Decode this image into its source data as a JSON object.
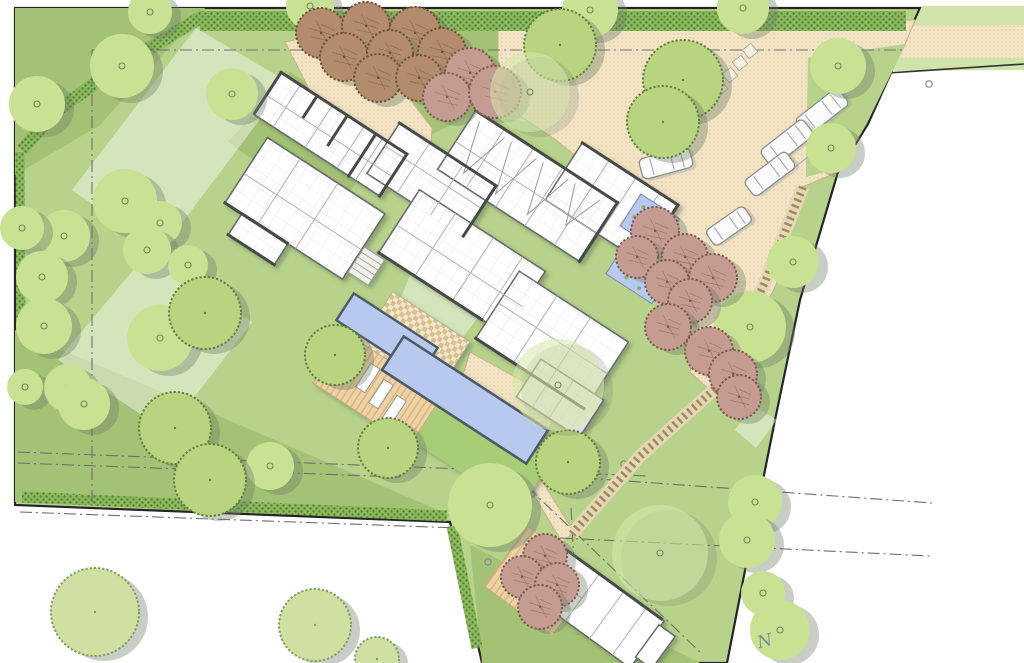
{
  "north_label": "N",
  "palette": {
    "base": "#b6d28b",
    "dark": "#a4c275",
    "hedge_bg": "#8cba5e",
    "hedge_dot": "#567f33",
    "sand": "#f2e4c5",
    "sand_dot": "#e0c9a0",
    "sand_edge": "#cbb286",
    "wood": "#ecd2a5",
    "wood_stripe": "#d8b27c",
    "pool": "#b7c9ee",
    "pool_edge": "#4f5a66",
    "wall": "#4a4a4a",
    "wall_light": "#6a6a6a",
    "room_line": "#b2b2b2",
    "boundary": "#252525",
    "dashline": "#6f6f6f",
    "tree_plain": "#c8e193",
    "tree_ring": "#74865c",
    "shadow": "#6f7f69",
    "tex_green": "#b9d47f",
    "tex_green_outline": "#5f7f3f",
    "tex_pale": "#cfe0a2",
    "tex_pale_outline": "#7f9f5f",
    "orchard": "#b28c6c",
    "orchard_outline": "#6e5138",
    "pink": "#c59c92",
    "pink_outline": "#80574d",
    "canopy": "#d7e8ab",
    "car_body": "#fbfbfb",
    "car_edge": "#8f8f8f",
    "road_verge": "#cfe3aa",
    "bright_panel": "#a7cd76",
    "pond_plant": "#7fae5e"
  },
  "site": {
    "outline": [
      [
        15,
        8
      ],
      [
        920,
        8
      ],
      [
        868,
        124
      ],
      [
        838,
        172
      ],
      [
        800,
        300
      ],
      [
        775,
        420
      ],
      [
        748,
        555
      ],
      [
        727,
        663
      ],
      [
        482,
        663
      ],
      [
        450,
        522
      ],
      [
        15,
        505
      ]
    ]
  },
  "lawn": {
    "dark": [
      [
        [
          15,
          8
        ],
        [
          205,
          8
        ],
        [
          100,
          125
        ],
        [
          15,
          175
        ]
      ],
      [
        [
          290,
          72
        ],
        [
          392,
          140
        ],
        [
          330,
          215
        ],
        [
          228,
          142
        ]
      ],
      [
        [
          15,
          330
        ],
        [
          240,
          425
        ],
        [
          452,
          516
        ],
        [
          15,
          502
        ]
      ],
      [
        [
          470,
          545
        ],
        [
          700,
          663
        ],
        [
          482,
          663
        ]
      ],
      [
        [
          300,
          22
        ],
        [
          505,
          22
        ],
        [
          505,
          100
        ],
        [
          430,
          135
        ],
        [
          330,
          70
        ]
      ]
    ],
    "pale": [
      [
        [
          196,
          28
        ],
        [
          288,
          82
        ],
        [
          160,
          252
        ],
        [
          72,
          190
        ]
      ],
      [
        [
          150,
          250
        ],
        [
          252,
          322
        ],
        [
          168,
          432
        ],
        [
          58,
          360
        ]
      ],
      [
        [
          410,
          275
        ],
        [
          492,
          300
        ],
        [
          455,
          347
        ],
        [
          388,
          330
        ]
      ],
      [
        [
          505,
          58
        ],
        [
          592,
          58
        ],
        [
          592,
          133
        ],
        [
          505,
          118
        ]
      ],
      [
        [
          752,
          405
        ],
        [
          777,
          420
        ],
        [
          756,
          448
        ],
        [
          735,
          430
        ]
      ]
    ]
  },
  "road": {
    "verge_top": [
      [
        922,
        6
      ],
      [
        1024,
        6
      ],
      [
        1024,
        25
      ],
      [
        913,
        26
      ]
    ],
    "lane": [
      [
        913,
        26
      ],
      [
        1024,
        25
      ],
      [
        1024,
        58
      ],
      [
        895,
        58
      ]
    ],
    "verge_bottom": [
      [
        895,
        58
      ],
      [
        1024,
        58
      ],
      [
        1024,
        70
      ],
      [
        888,
        71
      ]
    ],
    "edge_line": [
      [
        888,
        73
      ],
      [
        1024,
        64
      ]
    ]
  },
  "driveway": {
    "areas": [
      [
        [
          498,
          20
        ],
        [
          915,
          20
        ],
        [
          906,
          42
        ],
        [
          866,
          124
        ],
        [
          838,
          172
        ],
        [
          800,
          188
        ],
        [
          776,
          285
        ],
        [
          745,
          345
        ],
        [
          712,
          392
        ],
        [
          690,
          372
        ],
        [
          700,
          300
        ],
        [
          660,
          250
        ],
        [
          640,
          228
        ],
        [
          600,
          176
        ],
        [
          556,
          140
        ],
        [
          520,
          116
        ],
        [
          498,
          60
        ]
      ],
      [
        [
          285,
          42
        ],
        [
          340,
          30
        ],
        [
          395,
          80
        ],
        [
          432,
          128
        ],
        [
          430,
          162
        ],
        [
          372,
          152
        ],
        [
          312,
          95
        ]
      ],
      [
        [
          470,
          352
        ],
        [
          560,
          402
        ],
        [
          532,
          470
        ],
        [
          448,
          424
        ]
      ],
      [
        [
          530,
          462
        ],
        [
          574,
          532
        ],
        [
          562,
          542
        ],
        [
          520,
          472
        ]
      ]
    ],
    "green_wedge": [
      [
        808,
        58
      ],
      [
        906,
        44
      ],
      [
        866,
        124
      ],
      [
        840,
        168
      ],
      [
        806,
        177
      ]
    ]
  },
  "hedges": [
    {
      "pts": [
        [
          200,
          21
        ],
        [
          906,
          21
        ]
      ],
      "w": 20
    },
    {
      "pts": [
        [
          203,
          16
        ],
        [
          120,
          66
        ],
        [
          55,
          112
        ],
        [
          22,
          150
        ]
      ],
      "w": 13
    },
    {
      "pts": [
        [
          20,
          152
        ],
        [
          21,
          332
        ]
      ],
      "w": 9
    },
    {
      "pts": [
        [
          22,
          497
        ],
        [
          447,
          516
        ]
      ],
      "w": 11
    },
    {
      "pts": [
        [
          452,
          526
        ],
        [
          477,
          648
        ]
      ],
      "w": 11
    }
  ],
  "survey": {
    "lines": [
      [
        [
          92,
          50
        ],
        [
          906,
          50
        ]
      ],
      [
        [
          92,
          50
        ],
        [
          92,
          505
        ]
      ],
      [
        [
          18,
          452
        ],
        [
          648,
          476
        ]
      ],
      [
        [
          18,
          463
        ],
        [
          400,
          477
        ]
      ],
      [
        [
          585,
          478
        ],
        [
          932,
          503
        ]
      ],
      [
        [
          560,
          538
        ],
        [
          930,
          556
        ]
      ],
      [
        [
          512,
          472
        ],
        [
          700,
          652
        ]
      ],
      [
        [
          571,
          508
        ],
        [
          578,
          635
        ]
      ],
      [
        [
          20,
          512
        ],
        [
          458,
          528
        ]
      ]
    ],
    "markers": [
      [
        929,
        84
      ],
      [
        532,
        494
      ],
      [
        488,
        562
      ],
      [
        624,
        464
      ],
      [
        757,
        546
      ]
    ]
  },
  "paths": {
    "boardwalk": [
      [
        803,
        187
      ],
      [
        765,
        282
      ],
      [
        718,
        386
      ],
      [
        640,
        456
      ],
      [
        572,
        534
      ]
    ],
    "pavers": [
      {
        "cx": 720,
        "cy": 88,
        "rot": -38,
        "s": 11
      },
      {
        "cx": 730,
        "cy": 75,
        "rot": -38,
        "s": 11
      },
      {
        "cx": 740,
        "cy": 63,
        "rot": -38,
        "s": 11
      },
      {
        "cx": 750,
        "cy": 51,
        "rot": -38,
        "s": 11
      },
      {
        "cx": 618,
        "cy": 172,
        "rot": 33,
        "s": 12
      },
      {
        "cx": 629,
        "cy": 183,
        "rot": 33,
        "s": 12
      },
      {
        "cx": 640,
        "cy": 194,
        "rot": 33,
        "s": 12
      }
    ],
    "red_deck": {
      "cx": 540,
      "cy": 581,
      "w": 84,
      "h": 74,
      "rot": 36
    }
  },
  "pool": {
    "panel": {
      "cx": 472,
      "cy": 445,
      "w": 150,
      "h": 58,
      "rot": 33
    },
    "deck": {
      "cx": 380,
      "cy": 386,
      "w": 115,
      "h": 68,
      "rot": 33
    },
    "ramp": {
      "cx": 415,
      "cy": 342,
      "w": 92,
      "h": 60,
      "rot": 33
    },
    "small": {
      "cx": 387,
      "cy": 334,
      "w": 100,
      "h": 32,
      "rot": 33
    },
    "lap": {
      "cx": 465,
      "cy": 400,
      "w": 172,
      "h": 40,
      "rot": 33
    },
    "loungers": [
      {
        "cx": 368,
        "cy": 378,
        "w": 28,
        "h": 11,
        "rot": -57
      },
      {
        "cx": 381,
        "cy": 394,
        "w": 28,
        "h": 11,
        "rot": -57
      },
      {
        "cx": 394,
        "cy": 410,
        "w": 28,
        "h": 11,
        "rot": -57
      }
    ]
  },
  "house": {
    "origin": [
      270,
      95
    ],
    "rotation": 33,
    "volumes": [
      [
        -3,
        -25,
        150,
        50
      ],
      [
        21,
        37,
        140,
        78
      ],
      [
        41,
        114,
        55,
        26
      ],
      [
        124,
        -47,
        115,
        60
      ],
      [
        177,
        -2,
        150,
        75
      ],
      [
        181,
        -99,
        170,
        70
      ],
      [
        288,
        -130,
        115,
        68
      ],
      [
        305,
        12,
        130,
        80
      ],
      [
        371,
        74,
        75,
        45
      ]
    ],
    "walls": [
      [
        -3,
        -25,
        147,
        -25
      ],
      [
        -3,
        -25,
        -3,
        23
      ],
      [
        124,
        -47,
        238,
        -47
      ],
      [
        181,
        -99,
        350,
        -99
      ],
      [
        288,
        -130,
        402,
        -130
      ],
      [
        402,
        -130,
        402,
        -64
      ],
      [
        21,
        115,
        95,
        115
      ],
      [
        305,
        92,
        434,
        92
      ],
      [
        177,
        73,
        300,
        73
      ],
      [
        41,
        140,
        96,
        140
      ],
      [
        40,
        -25,
        40,
        0
      ],
      [
        76,
        -25,
        76,
        10
      ],
      [
        110,
        -25,
        110,
        25
      ],
      [
        147,
        -25,
        147,
        25
      ],
      [
        239,
        -47,
        239,
        13
      ],
      [
        350,
        -99,
        350,
        -29
      ]
    ],
    "room_lines": [
      [
        20,
        -25,
        20,
        25
      ],
      [
        58,
        -25,
        58,
        25
      ],
      [
        96,
        -25,
        96,
        25
      ],
      [
        118,
        -25,
        118,
        25
      ],
      [
        -3,
        2,
        147,
        2
      ],
      [
        60,
        37,
        60,
        115
      ],
      [
        105,
        37,
        105,
        115
      ],
      [
        21,
        80,
        161,
        80
      ],
      [
        160,
        -47,
        160,
        13
      ],
      [
        200,
        -47,
        200,
        13
      ],
      [
        124,
        -20,
        239,
        -20
      ],
      [
        220,
        -2,
        220,
        73
      ],
      [
        265,
        -2,
        265,
        73
      ],
      [
        300,
        -2,
        300,
        73
      ],
      [
        177,
        40,
        327,
        40
      ],
      [
        215,
        -99,
        215,
        -29
      ],
      [
        250,
        -99,
        250,
        -29
      ],
      [
        285,
        -99,
        285,
        -29
      ],
      [
        320,
        -99,
        320,
        -29
      ],
      [
        181,
        -62,
        351,
        -62
      ],
      [
        320,
        -130,
        320,
        -62
      ],
      [
        352,
        -130,
        352,
        -62
      ],
      [
        380,
        -130,
        380,
        -64
      ],
      [
        305,
        50,
        435,
        50
      ],
      [
        350,
        12,
        350,
        92
      ],
      [
        390,
        12,
        390,
        92
      ],
      [
        390,
        74,
        390,
        119
      ],
      [
        410,
        74,
        410,
        119
      ]
    ],
    "zigzags": [
      [
        190,
        -92,
        30,
        52
      ],
      [
        228,
        -92,
        30,
        52
      ],
      [
        266,
        -92,
        30,
        52
      ],
      [
        304,
        -92,
        30,
        40
      ]
    ],
    "steps": {
      "x": 162,
      "y": 76,
      "w": 24,
      "h": 30,
      "n": 5
    }
  },
  "ponds": {
    "rects": [
      [
        365,
        -119,
        46,
        38
      ],
      [
        379,
        -73,
        55,
        40
      ]
    ],
    "stones": [
      [
        384,
        -90,
        12,
        9
      ],
      [
        398,
        -85,
        12,
        9
      ]
    ]
  },
  "outbuilding": {
    "origin": [
      598,
      610
    ],
    "rotation": 36,
    "volumes": [
      [
        -62,
        -30,
        122,
        58
      ],
      [
        -82,
        -8,
        20,
        32
      ],
      [
        58,
        -24,
        20,
        40
      ]
    ],
    "lines": [
      [
        -20,
        -30,
        -20,
        28
      ],
      [
        10,
        -30,
        10,
        28
      ],
      [
        38,
        -30,
        38,
        28
      ],
      [
        -62,
        0,
        -20,
        0
      ]
    ],
    "dark": [
      [
        -62,
        -30,
        58,
        -30
      ]
    ]
  },
  "vehicles": [
    {
      "cx": 666,
      "cy": 163,
      "rot": -15,
      "l": 52,
      "w": 21
    },
    {
      "cx": 729,
      "cy": 226,
      "rot": -35,
      "l": 46,
      "w": 19
    },
    {
      "cx": 822,
      "cy": 112,
      "rot": -38,
      "l": 54,
      "w": 21
    },
    {
      "cx": 787,
      "cy": 143,
      "rot": -38,
      "l": 54,
      "w": 21
    },
    {
      "cx": 770,
      "cy": 174,
      "rot": -37,
      "l": 52,
      "w": 20
    }
  ],
  "bay_lines": [
    [
      800,
      130,
      843,
      96
    ],
    [
      783,
      160,
      826,
      126
    ],
    [
      766,
      190,
      809,
      156
    ]
  ],
  "trees": {
    "plain": [
      [
        37,
        104,
        28
      ],
      [
        122,
        66,
        32
      ],
      [
        150,
        12,
        22
      ],
      [
        232,
        94,
        26
      ],
      [
        310,
        6,
        24
      ],
      [
        125,
        201,
        32
      ],
      [
        64,
        236,
        26
      ],
      [
        160,
        223,
        22
      ],
      [
        147,
        250,
        24
      ],
      [
        22,
        228,
        22
      ],
      [
        42,
        277,
        26
      ],
      [
        44,
        326,
        28
      ],
      [
        160,
        338,
        33
      ],
      [
        188,
        265,
        20
      ],
      [
        25,
        387,
        18
      ],
      [
        68,
        388,
        24
      ],
      [
        84,
        404,
        26
      ],
      [
        270,
        466,
        24
      ],
      [
        490,
        505,
        42
      ],
      [
        590,
        10,
        28
      ],
      [
        743,
        8,
        26
      ],
      [
        838,
        66,
        28
      ],
      [
        831,
        148,
        25
      ],
      [
        793,
        262,
        26
      ],
      [
        750,
        327,
        36
      ],
      [
        755,
        502,
        27
      ],
      [
        747,
        540,
        28
      ],
      [
        763,
        593,
        22
      ],
      [
        780,
        630,
        30
      ]
    ],
    "canopy": [
      [
        558,
        385,
        46
      ],
      [
        660,
        553,
        48
      ],
      [
        530,
        92,
        40
      ]
    ],
    "textured": [
      [
        205,
        313,
        36
      ],
      [
        175,
        428,
        36
      ],
      [
        210,
        480,
        36
      ],
      [
        335,
        355,
        30
      ],
      [
        388,
        448,
        30
      ],
      [
        568,
        462,
        32
      ],
      [
        560,
        45,
        36
      ],
      [
        683,
        80,
        40
      ],
      [
        663,
        122,
        36
      ]
    ],
    "textured_pale": [
      [
        95,
        612,
        44
      ],
      [
        315,
        625,
        36
      ],
      [
        377,
        659,
        22
      ]
    ],
    "orchard": [
      [
        321,
        33,
        25
      ],
      [
        366,
        26,
        24
      ],
      [
        415,
        33,
        26
      ],
      [
        344,
        57,
        24
      ],
      [
        390,
        53,
        23
      ],
      [
        442,
        52,
        24
      ],
      [
        378,
        78,
        24
      ],
      [
        419,
        78,
        23
      ]
    ],
    "orchard_pink": [
      [
        470,
        73,
        25
      ],
      [
        447,
        97,
        24
      ],
      [
        495,
        92,
        26
      ]
    ],
    "accent": [
      [
        655,
        231,
        24
      ],
      [
        637,
        257,
        21
      ],
      [
        685,
        257,
        23
      ],
      [
        667,
        282,
        22
      ],
      [
        713,
        278,
        24
      ],
      [
        690,
        301,
        22
      ],
      [
        668,
        327,
        23
      ],
      [
        709,
        351,
        24
      ],
      [
        733,
        374,
        24
      ],
      [
        739,
        397,
        22
      ],
      [
        545,
        556,
        22
      ],
      [
        522,
        577,
        21
      ],
      [
        557,
        585,
        22
      ],
      [
        540,
        607,
        22
      ]
    ]
  }
}
